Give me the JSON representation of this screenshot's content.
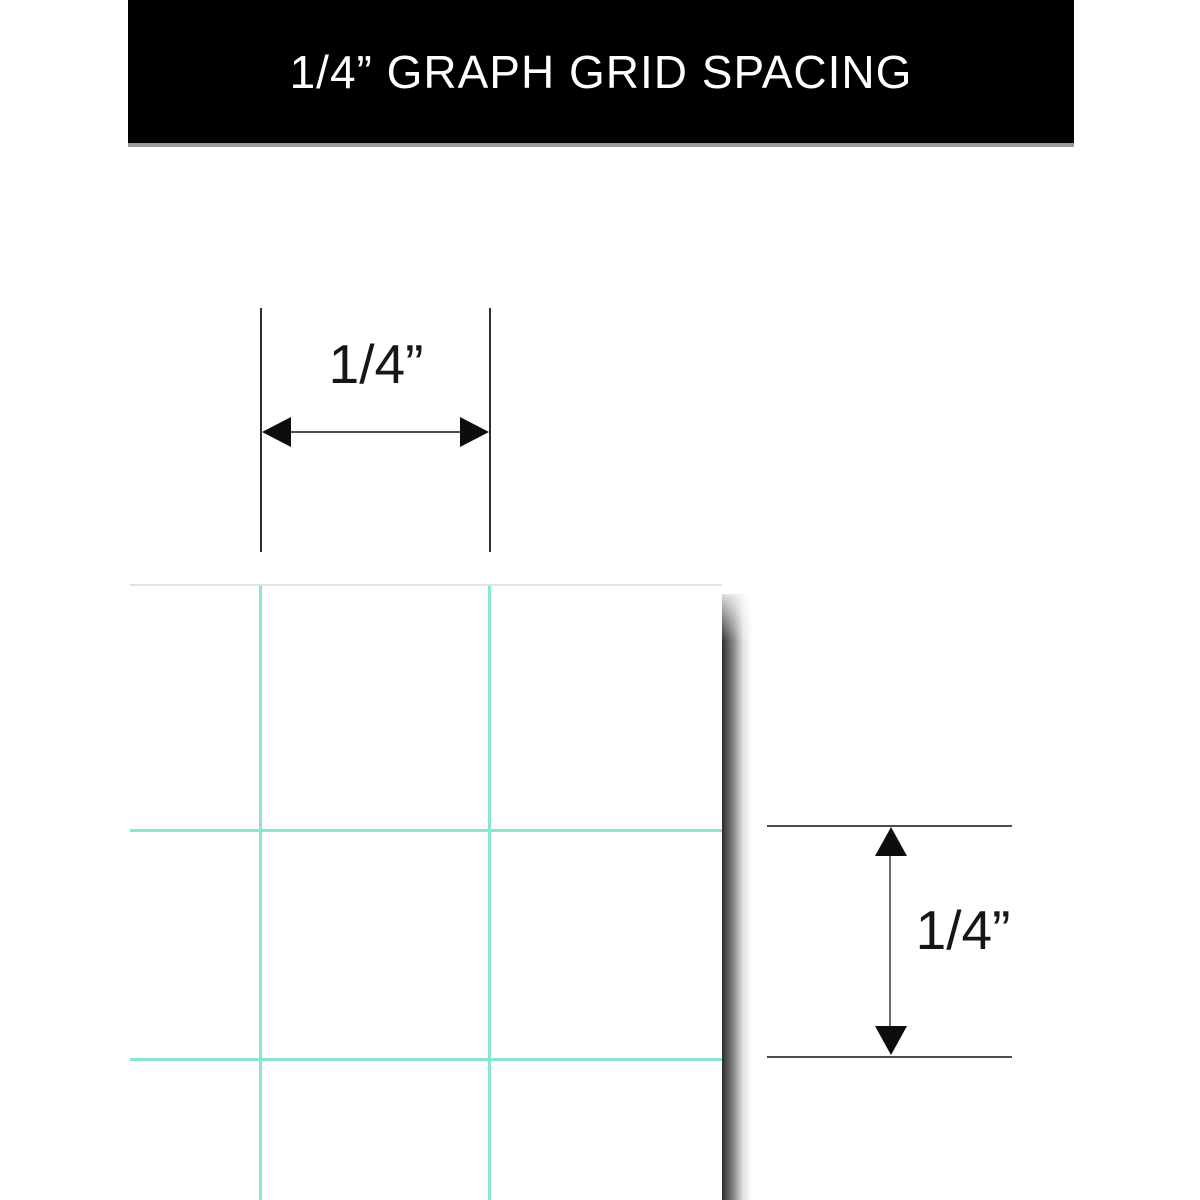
{
  "banner": {
    "title": "1/4” GRAPH GRID SPACING",
    "bg_color": "#000000",
    "text_color": "#ffffff",
    "border_color": "#9c9c9c"
  },
  "horizontal_dimension": {
    "label": "1/4”"
  },
  "vertical_dimension": {
    "label": "1/4”"
  },
  "graph_paper": {
    "grid_color": "#8ae6d3",
    "paper_color": "#ffffff",
    "shadow_color": "#1c1c1c",
    "grid_spacing_px": 229
  }
}
